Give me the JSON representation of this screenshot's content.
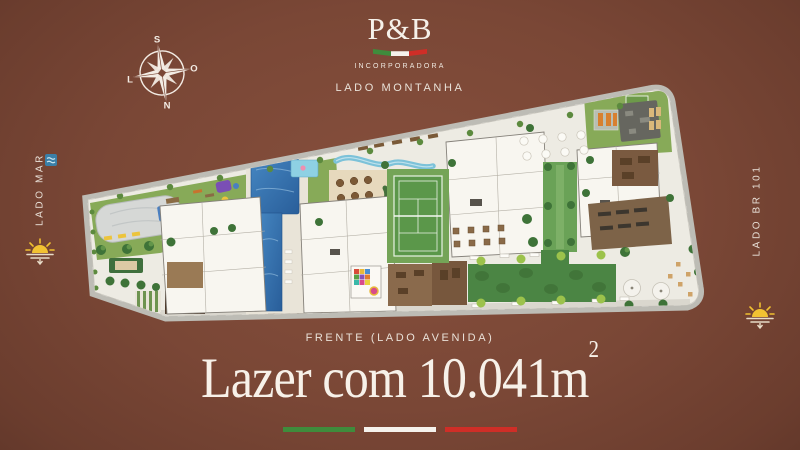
{
  "logo": {
    "title": "P&B",
    "subtitle": "INCORPORADORA"
  },
  "compass": {
    "top": "S",
    "right": "O",
    "bottom": "N",
    "left": "L"
  },
  "sides": {
    "top": "LADO MONTANHA",
    "left": "LADO MAR",
    "right": "LADO BR 101",
    "bottom": "FRENTE (LADO AVENIDA)"
  },
  "headline": {
    "text": "Lazer com 10.041m",
    "sup": "2"
  },
  "icons": {
    "left_side": "waves-icon",
    "left_bottom": "sunset-icon",
    "right_bottom": "sunset-icon"
  },
  "colors": {
    "background": "#7a4736",
    "flag_green": "#3f8c3c",
    "flag_white": "#f5f2ec",
    "flag_red": "#cf2e27",
    "text": "#f3ece4",
    "lawn": "#87aa58",
    "pool": "#3577b2",
    "court": "#5b974a"
  }
}
